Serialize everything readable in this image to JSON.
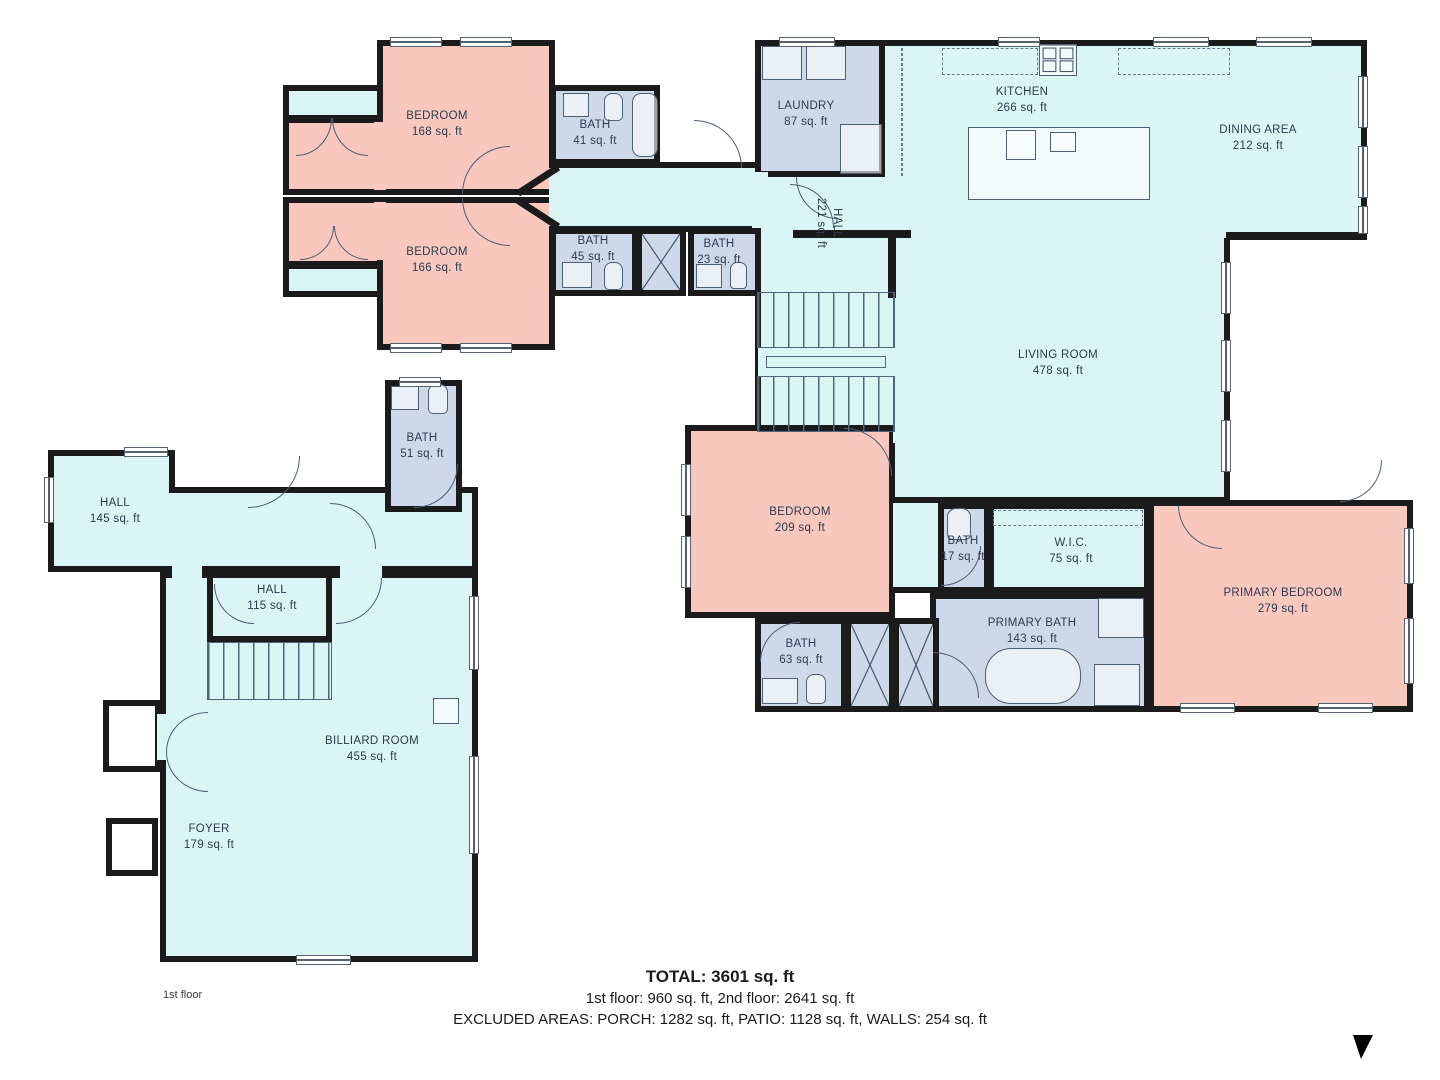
{
  "title": "Floor plan – 1st floor",
  "floor_label": "1st floor",
  "rooms": [
    {
      "name": "BEDROOM",
      "area": "168 sq. ft",
      "type": "bedroom"
    },
    {
      "name": "BATH",
      "area": "41 sq. ft",
      "type": "bath"
    },
    {
      "name": "BEDROOM",
      "area": "166 sq. ft",
      "type": "bedroom"
    },
    {
      "name": "BATH",
      "area": "45 sq. ft",
      "type": "bath"
    },
    {
      "name": "BATH",
      "area": "23 sq. ft",
      "type": "bath"
    },
    {
      "name": "LAUNDRY",
      "area": "87 sq. ft",
      "type": "utility"
    },
    {
      "name": "KITCHEN",
      "area": "266 sq. ft",
      "type": "living"
    },
    {
      "name": "DINING AREA",
      "area": "212 sq. ft",
      "type": "living"
    },
    {
      "name": "HALL",
      "area": "221 sq. ft",
      "type": "hall"
    },
    {
      "name": "LIVING ROOM",
      "area": "478 sq. ft",
      "type": "living"
    },
    {
      "name": "BEDROOM",
      "area": "209 sq. ft",
      "type": "bedroom"
    },
    {
      "name": "BATH",
      "area": "17 sq. ft",
      "type": "bath"
    },
    {
      "name": "W.I.C.",
      "area": "75 sq. ft",
      "type": "closet"
    },
    {
      "name": "PRIMARY BEDROOM",
      "area": "279 sq. ft",
      "type": "bedroom"
    },
    {
      "name": "PRIMARY BATH",
      "area": "143 sq. ft",
      "type": "bath"
    },
    {
      "name": "BATH",
      "area": "63 sq. ft",
      "type": "bath"
    },
    {
      "name": "BATH",
      "area": "51 sq. ft",
      "type": "bath"
    },
    {
      "name": "HALL",
      "area": "145 sq. ft",
      "type": "hall"
    },
    {
      "name": "HALL",
      "area": "115 sq. ft",
      "type": "hall"
    },
    {
      "name": "BILLIARD ROOM",
      "area": "455 sq. ft",
      "type": "living"
    },
    {
      "name": "FOYER",
      "area": "179 sq. ft",
      "type": "hall"
    }
  ],
  "summary": {
    "total_line": "TOTAL: 3601 sq. ft",
    "floors_line": "1st floor: 960 sq. ft, 2nd floor: 2641 sq. ft",
    "excluded_line": "EXCLUDED AREAS: PORCH: 1282 sq. ft, PATIO: 1128 sq. ft, WALLS: 254 sq. ft"
  },
  "colors": {
    "open_space_fill": "#dbf5f5",
    "bedroom_fill": "#f8c8be",
    "bath_fill": "#cdd9e8",
    "wall": "#1b1b1b",
    "label_text": "#2d3b4d"
  },
  "icons": {
    "corner_marker": "black-triangle-marker"
  }
}
